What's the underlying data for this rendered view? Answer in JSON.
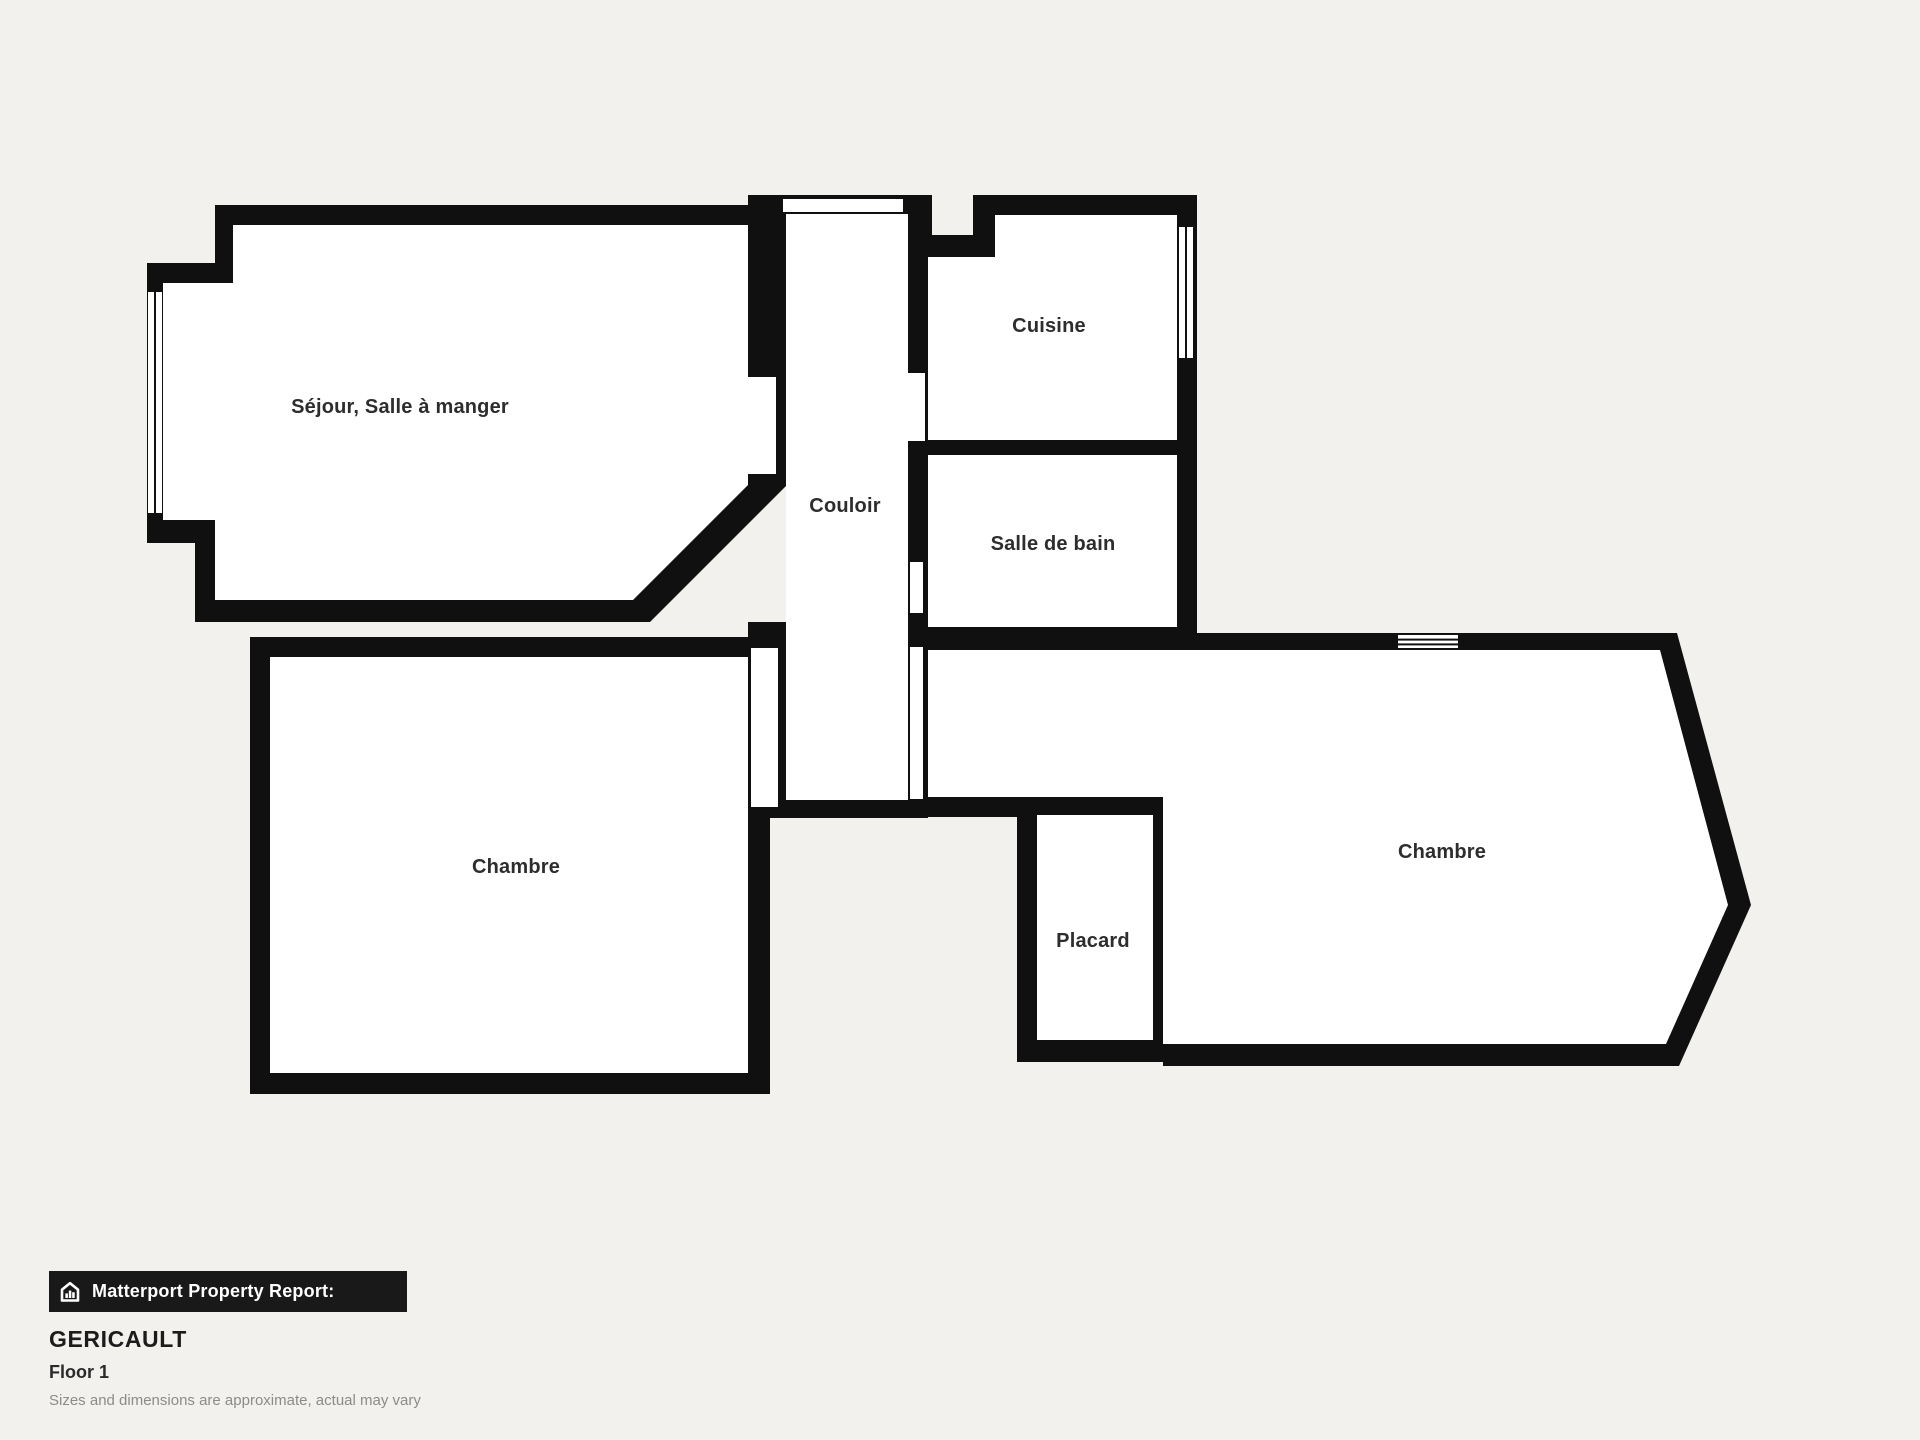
{
  "plan": {
    "colors": {
      "background": "#f2f1ed",
      "wall": "#101010",
      "floor": "#ffffff",
      "label": "#2d2d2d"
    },
    "rooms": [
      {
        "id": "sejour",
        "label": "Séjour, Salle à manger"
      },
      {
        "id": "couloir",
        "label": "Couloir"
      },
      {
        "id": "cuisine",
        "label": "Cuisine"
      },
      {
        "id": "salle-de-bain",
        "label": "Salle de bain"
      },
      {
        "id": "chambre-left",
        "label": "Chambre"
      },
      {
        "id": "placard",
        "label": "Placard"
      },
      {
        "id": "chambre-right",
        "label": "Chambre"
      }
    ]
  },
  "footer": {
    "report_label": "Matterport Property Report:",
    "property_name": "GERICAULT",
    "floor_label": "Floor 1",
    "disclaimer": "Sizes and dimensions are approximate, actual may vary"
  }
}
